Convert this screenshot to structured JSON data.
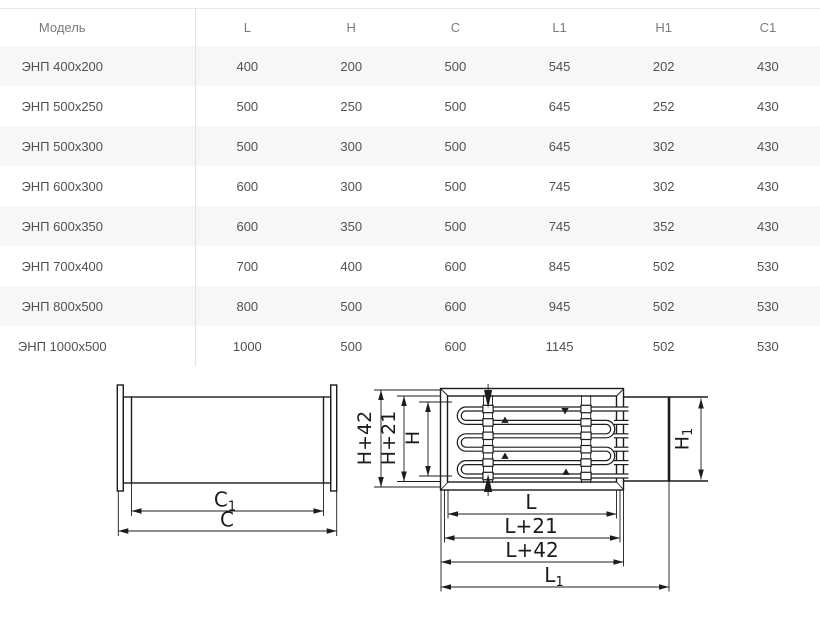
{
  "table": {
    "header": [
      "Модель",
      "L",
      "H",
      "C",
      "L1",
      "H1",
      "C1"
    ],
    "rows": [
      [
        "ЭНП 400x200",
        "400",
        "200",
        "500",
        "545",
        "202",
        "430"
      ],
      [
        "ЭНП 500x250",
        "500",
        "250",
        "500",
        "645",
        "252",
        "430"
      ],
      [
        "ЭНП 500x300",
        "500",
        "300",
        "500",
        "645",
        "302",
        "430"
      ],
      [
        "ЭНП 600x300",
        "600",
        "300",
        "500",
        "745",
        "302",
        "430"
      ],
      [
        "ЭНП 600x350",
        "600",
        "350",
        "500",
        "745",
        "352",
        "430"
      ],
      [
        "ЭНП 700x400",
        "700",
        "400",
        "600",
        "845",
        "502",
        "530"
      ],
      [
        "ЭНП 800x500",
        "800",
        "500",
        "600",
        "945",
        "502",
        "530"
      ],
      [
        "ЭНП 1000x500",
        "1000",
        "500",
        "600",
        "1145",
        "502",
        "530"
      ]
    ]
  },
  "drawings": {
    "side_view": {
      "dim_c1": {
        "base": "C",
        "sub": "1"
      },
      "dim_c": "C"
    },
    "top_view": {
      "dim_h42": "H+42",
      "dim_h21": "H+21",
      "dim_h": "H",
      "dim_h1": {
        "base": "H",
        "sub": "1"
      },
      "dim_l": "L",
      "dim_l21": "L+21",
      "dim_l42": "L+42",
      "dim_l1": {
        "base": "L",
        "sub": "1"
      }
    }
  },
  "colors": {
    "row_stripe": "#f7f7f8",
    "table_divider": "#e4e4e4",
    "header_text": "#7b7b7b",
    "cell_text": "#515155",
    "drawing_line": "#1c1c1c"
  }
}
